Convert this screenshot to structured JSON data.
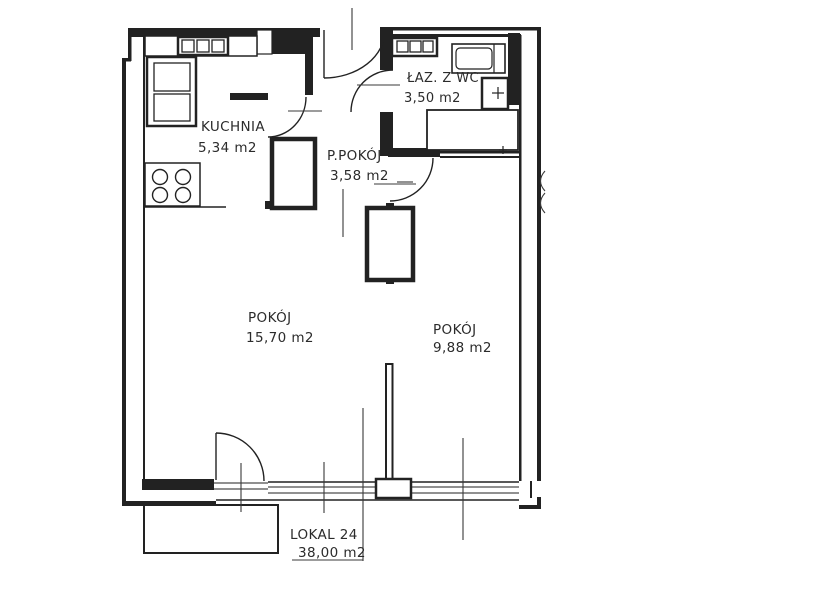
{
  "plan": {
    "title": "Apartment floor plan",
    "rooms": [
      {
        "name": "KUCHNIA",
        "area": "5,34  m2"
      },
      {
        "name": "P.POKÓJ",
        "area": "3,58  m2"
      },
      {
        "name": "ŁAZ. Z WC",
        "area": "3,50  m2"
      },
      {
        "name": "POKÓJ",
        "area": "15,70 m2"
      },
      {
        "name": "POKÓJ",
        "area": "9,88  m2"
      }
    ],
    "unit_label": {
      "name": "LOKAL 24",
      "area": "38,00 m2"
    },
    "fixtures": [
      "kitchen-hob",
      "kitchen-sink",
      "kitchen-stove",
      "hall-wardrobe-1",
      "hall-wardrobe-2",
      "bath-washbasin",
      "bathtub",
      "toilet",
      "shower-area",
      "balcony",
      "window-band",
      "pillar"
    ],
    "colors": {
      "ink": "#222222",
      "paper": "#ffffff"
    }
  }
}
